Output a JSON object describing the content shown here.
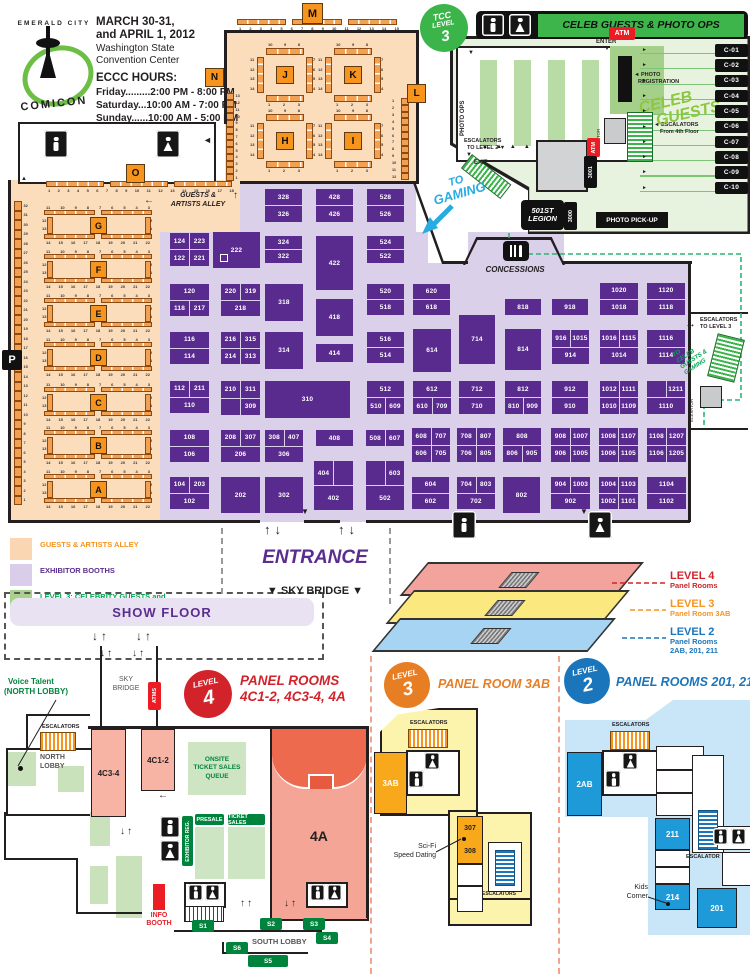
{
  "header": {
    "logo_top": "EMERALD CITY",
    "logo_bottom": "COMICON",
    "dates_l1": "MARCH 30-31,",
    "dates_l2": "and APRIL 1, 2012",
    "venue_l1": "Washington State",
    "venue_l2": "Convention Center",
    "hours_title": "ECCC HOURS:",
    "hours": [
      "Friday.........2:00 PM - 8:00 PM",
      "Saturday...10:00 AM - 7:00 PM",
      "Sunday......10:00 AM - 5:00 PM"
    ]
  },
  "markers": {
    "m": "M",
    "n": "N",
    "l": "L",
    "o": "O",
    "p": "P"
  },
  "tcc": {
    "badge_l1": "TCC",
    "badge_l2": "LEVEL",
    "badge_l3": "3",
    "banner": "CELEB GUESTS & PHOTO OPS",
    "enter": "ENTER",
    "exit": "EXIT",
    "photo_ops": "PHOTO OPS",
    "photo_reg_l1": "PHOTO",
    "photo_reg_l2": "REGISTRATION",
    "elevator": "ELEVATOR",
    "esc4_l1": "ESCALATORS",
    "esc4_l2": "From 4th Floor",
    "esc2_l1": "ESCALATORS",
    "esc2_l2": "TO LEVEL 2",
    "atm": "ATM",
    "to_gaming_l1": "TO",
    "to_gaming_l2": "GAMING",
    "r3001": "3001",
    "legion_l1": "501ST",
    "legion_l2": "LEGION",
    "r3000": "3000",
    "photo_pickup": "PHOTO PICK-UP",
    "celeb_l1": "CELEB",
    "celeb_l2": "GUESTS",
    "booths": [
      "C-01",
      "C-02",
      "C-03",
      "C-04",
      "C-05",
      "C-06",
      "C-07",
      "C-08",
      "C-09",
      "C-10"
    ]
  },
  "alley": {
    "title_l1": "GUESTS &",
    "title_l2": "ARTISTS ALLEY",
    "rows": [
      "G",
      "F",
      "E",
      "D",
      "C",
      "B",
      "A"
    ],
    "top_left": [
      "11",
      "10",
      "9",
      "8"
    ],
    "top_right": [
      "7",
      "6",
      "5",
      "4",
      "3"
    ],
    "bottom_left": [
      "14",
      "15",
      "16",
      "17"
    ],
    "bottom_right": [
      "18",
      "19",
      "20",
      "21",
      "22"
    ],
    "side_left": [
      "12",
      "13"
    ],
    "side_right": [
      "2",
      "1"
    ],
    "west_wall": [
      "32",
      "31",
      "30",
      "29",
      "28",
      "27",
      "26",
      "25",
      "24",
      "23",
      "22",
      "21",
      "20",
      "19",
      "18",
      "17",
      "16",
      "15",
      "14",
      "13",
      "12",
      "11",
      "10",
      "9",
      "8",
      "7",
      "6",
      "5",
      "4",
      "3",
      "2",
      "1"
    ],
    "o_wall": [
      "1",
      "2",
      "3",
      "4",
      "5",
      "6",
      "7",
      "8",
      "9",
      "10",
      "11",
      "12",
      "13",
      "14",
      "15",
      "16",
      "17",
      "18"
    ],
    "m_wall": [
      "1",
      "2",
      "3",
      "4",
      "5",
      "6",
      "7",
      "8",
      "9",
      "10",
      "11",
      "12",
      "13",
      "14",
      "15"
    ],
    "n_wall": [
      "13",
      "12",
      "11",
      "10",
      "9",
      "8",
      "7",
      "6",
      "5",
      "4",
      "3",
      "2",
      "1"
    ],
    "l_wall": [
      "1",
      "2",
      "3",
      "4",
      "5",
      "6",
      "7",
      "8",
      "9",
      "10",
      "11",
      "12"
    ]
  },
  "islands": {
    "letters": [
      "J",
      "K",
      "H",
      "I"
    ],
    "top": [
      "10",
      "9",
      "8"
    ],
    "bottom": [
      "1",
      "2",
      "3"
    ],
    "left": [
      "11",
      "12",
      "13",
      "14"
    ],
    "right": [
      "7",
      "6",
      "5",
      "4"
    ]
  },
  "hall": {
    "concessions": "CONCESSIONS",
    "esc3_l1": "ESCALATORS",
    "esc3_l2": "TO LEVEL 3",
    "to_celeb_l1": "TO",
    "to_celeb_l2": "CELEB",
    "to_celeb_l3": "GUESTS &",
    "to_celeb_l4": "GAMING",
    "elevator": "ELEVATOR",
    "entrance": "ENTRANCE",
    "sky_bridge": "▼ SKY BRIDGE ▼"
  },
  "booths": [
    [
      265,
      189,
      37,
      33,
      [
        [
          "328"
        ],
        [
          "326"
        ]
      ]
    ],
    [
      316,
      189,
      37,
      33,
      [
        [
          "428"
        ],
        [
          "426"
        ]
      ]
    ],
    [
      367,
      189,
      37,
      33,
      [
        [
          "528"
        ],
        [
          "526"
        ]
      ]
    ],
    [
      170,
      233,
      39,
      33,
      [
        [
          "124",
          "223"
        ],
        [
          "122",
          "221"
        ]
      ]
    ],
    [
      213,
      232,
      47,
      36,
      [
        [
          "222"
        ]
      ],
      1
    ],
    [
      265,
      236,
      37,
      27,
      [
        [
          "324"
        ],
        [
          "322"
        ]
      ]
    ],
    [
      316,
      236,
      37,
      54,
      [
        [
          "422"
        ]
      ]
    ],
    [
      367,
      236,
      37,
      27,
      [
        [
          "524"
        ],
        [
          "522"
        ]
      ]
    ],
    [
      170,
      284,
      39,
      32,
      [
        [
          "120"
        ],
        [
          "118",
          "217"
        ]
      ]
    ],
    [
      221,
      284,
      39,
      32,
      [
        [
          "220",
          "319"
        ],
        [
          "218"
        ]
      ]
    ],
    [
      265,
      284,
      38,
      37,
      [
        [
          "318"
        ]
      ]
    ],
    [
      316,
      299,
      37,
      37,
      [
        [
          "418"
        ]
      ]
    ],
    [
      367,
      284,
      37,
      31,
      [
        [
          "520"
        ],
        [
          "518"
        ]
      ]
    ],
    [
      413,
      284,
      37,
      31,
      [
        [
          "620"
        ],
        [
          "618"
        ]
      ]
    ],
    [
      505,
      299,
      36,
      16,
      [
        [
          "818"
        ]
      ]
    ],
    [
      552,
      299,
      36,
      16,
      [
        [
          "918"
        ]
      ]
    ],
    [
      600,
      283,
      38,
      32,
      [
        [
          "1020"
        ],
        [
          "1018"
        ]
      ]
    ],
    [
      647,
      283,
      38,
      32,
      [
        [
          "1120"
        ],
        [
          "1118"
        ]
      ]
    ],
    [
      170,
      332,
      39,
      32,
      [
        [
          "116"
        ],
        [
          "114"
        ]
      ]
    ],
    [
      221,
      332,
      39,
      32,
      [
        [
          "216",
          "315"
        ],
        [
          "214",
          "313"
        ]
      ]
    ],
    [
      265,
      332,
      38,
      37,
      [
        [
          "314"
        ]
      ]
    ],
    [
      316,
      344,
      37,
      18,
      [
        [
          "414"
        ]
      ]
    ],
    [
      367,
      332,
      37,
      31,
      [
        [
          "516"
        ],
        [
          "514"
        ]
      ]
    ],
    [
      413,
      329,
      38,
      43,
      [
        [
          "614"
        ]
      ]
    ],
    [
      459,
      315,
      36,
      49,
      [
        [
          "714"
        ]
      ]
    ],
    [
      505,
      329,
      36,
      41,
      [
        [
          "814"
        ]
      ]
    ],
    [
      552,
      330,
      37,
      34,
      [
        [
          "916",
          "1015"
        ],
        [
          "914"
        ]
      ]
    ],
    [
      600,
      330,
      38,
      34,
      [
        [
          "1016",
          "1115"
        ],
        [
          "1014"
        ]
      ]
    ],
    [
      647,
      330,
      38,
      34,
      [
        [
          "1116"
        ],
        [
          "1114"
        ]
      ]
    ],
    [
      170,
      381,
      39,
      32,
      [
        [
          "112",
          "211"
        ],
        [
          "110"
        ]
      ]
    ],
    [
      221,
      381,
      39,
      34,
      [
        [
          "210",
          "311"
        ],
        [
          "",
          "309"
        ]
      ]
    ],
    [
      265,
      381,
      85,
      37,
      [
        [
          "310"
        ]
      ]
    ],
    [
      367,
      381,
      37,
      33,
      [
        [
          "512"
        ],
        [
          "510",
          "609"
        ]
      ]
    ],
    [
      413,
      381,
      38,
      33,
      [
        [
          "612"
        ],
        [
          "610",
          "709"
        ]
      ]
    ],
    [
      459,
      381,
      36,
      33,
      [
        [
          "712"
        ],
        [
          "710"
        ]
      ]
    ],
    [
      505,
      381,
      36,
      33,
      [
        [
          "812"
        ],
        [
          "810",
          "909"
        ]
      ]
    ],
    [
      552,
      381,
      36,
      33,
      [
        [
          "912"
        ],
        [
          "910"
        ]
      ]
    ],
    [
      600,
      381,
      38,
      33,
      [
        [
          "1012",
          "1111"
        ],
        [
          "1010",
          "1109"
        ]
      ]
    ],
    [
      647,
      381,
      38,
      33,
      [
        [
          "",
          "1211"
        ],
        [
          "1110"
        ]
      ]
    ],
    [
      170,
      430,
      39,
      32,
      [
        [
          "108"
        ],
        [
          "106"
        ]
      ]
    ],
    [
      221,
      430,
      39,
      32,
      [
        [
          "208",
          "307"
        ],
        [
          "206"
        ]
      ]
    ],
    [
      265,
      430,
      38,
      32,
      [
        [
          "308",
          "407"
        ],
        [
          "306"
        ]
      ]
    ],
    [
      316,
      430,
      37,
      16,
      [
        [
          "408"
        ]
      ]
    ],
    [
      366,
      430,
      38,
      16,
      [
        [
          "508",
          "607"
        ]
      ]
    ],
    [
      412,
      428,
      38,
      34,
      [
        [
          "608",
          "707"
        ],
        [
          "606",
          "705"
        ]
      ]
    ],
    [
      457,
      428,
      38,
      34,
      [
        [
          "708",
          "807"
        ],
        [
          "706",
          "805"
        ]
      ]
    ],
    [
      503,
      428,
      38,
      34,
      [
        [
          "808"
        ],
        [
          "806",
          "905"
        ]
      ]
    ],
    [
      551,
      428,
      39,
      34,
      [
        [
          "908",
          "1007"
        ],
        [
          "906",
          "1005"
        ]
      ]
    ],
    [
      599,
      428,
      39,
      34,
      [
        [
          "1008",
          "1107"
        ],
        [
          "1006",
          "1105"
        ]
      ]
    ],
    [
      647,
      428,
      39,
      34,
      [
        [
          "1108",
          "1207"
        ],
        [
          "1106",
          "1205"
        ]
      ]
    ],
    [
      170,
      477,
      39,
      32,
      [
        [
          "104",
          "203"
        ],
        [
          "102"
        ]
      ]
    ],
    [
      221,
      477,
      39,
      36,
      [
        [
          "202"
        ]
      ]
    ],
    [
      265,
      477,
      38,
      36,
      [
        [
          "302"
        ]
      ]
    ],
    [
      314,
      461,
      39,
      49,
      [
        [
          "404",
          ""
        ],
        [
          "402"
        ]
      ]
    ],
    [
      366,
      461,
      38,
      49,
      [
        [
          "",
          "603"
        ],
        [
          "502"
        ]
      ]
    ],
    [
      412,
      477,
      37,
      32,
      [
        [
          "604"
        ],
        [
          "602"
        ]
      ]
    ],
    [
      457,
      477,
      38,
      32,
      [
        [
          "704",
          "803"
        ],
        [
          "702"
        ]
      ]
    ],
    [
      503,
      477,
      37,
      36,
      [
        [
          "802"
        ]
      ]
    ],
    [
      551,
      477,
      39,
      32,
      [
        [
          "904",
          "1003"
        ],
        [
          "902"
        ]
      ]
    ],
    [
      599,
      477,
      39,
      32,
      [
        [
          "1004",
          "1103"
        ],
        [
          "1002",
          "1101"
        ]
      ]
    ],
    [
      647,
      477,
      39,
      32,
      [
        [
          "1104"
        ],
        [
          "1102"
        ]
      ]
    ]
  ],
  "legend": {
    "items": [
      {
        "l1": "GUESTS & ARTISTS ALLEY",
        "l2": "",
        "fill": "#FAD7B2",
        "color": "#F7941D"
      },
      {
        "l1": "EXHIBITOR BOOTHS",
        "l2": "",
        "fill": "#D9CDE9",
        "color": "#5B2D8E"
      },
      {
        "l1": "LEVEL 3: CELEBRITY GUESTS and",
        "l2": "ESCALATORS TO GAMING",
        "fill": "#A9D18E",
        "color": "#00A651"
      }
    ]
  },
  "show_floor": "SHOW FLOOR",
  "levels_diagram": {
    "items": [
      {
        "label": "LEVEL 4",
        "sub1": "Panel Rooms",
        "sub2": "",
        "color": "#D2232A",
        "fill": "#F2A39B"
      },
      {
        "label": "LEVEL 3",
        "sub1": "Panel Room 3AB",
        "sub2": "",
        "color": "#F7941D",
        "fill": "#FBE87F"
      },
      {
        "label": "LEVEL 2",
        "sub1": "Panel Rooms",
        "sub2": "2AB, 201, 211",
        "color": "#1B75BB",
        "fill": "#A6D4F2"
      }
    ]
  },
  "level4": {
    "badge_l1": "LEVEL",
    "badge_l2": "4",
    "title_l1": "PANEL ROOMS",
    "title_l2": "4C1-2, 4C3-4, 4A",
    "voice_l1": "Voice Talent",
    "voice_l2": "(NORTH LOBBY)",
    "sky_l1": "SKY",
    "sky_l2": "BRIDGE",
    "atms": "ATMS",
    "escalators": "ESCALATORS",
    "lobby_l1": "NORTH",
    "lobby_l2": "LOBBY",
    "r4c34": "4C3-4",
    "r4c12": "4C1-2",
    "r4a": "4A",
    "queue_l1": "ONSITE",
    "queue_l2": "TICKET SALES",
    "queue_l3": "QUEUE",
    "presale": "PRESALE",
    "tickets": "TICKET SALES",
    "exreg": "EXHIBITOR REG.",
    "info_l1": "INFO",
    "info_l2": "BOOTH",
    "south": "SOUTH LOBBY",
    "stairs": [
      "S1",
      "S2",
      "S3",
      "S4",
      "S5",
      "S6"
    ]
  },
  "level3": {
    "badge_l1": "LEVEL",
    "badge_l2": "3",
    "title": "PANEL ROOM 3AB",
    "escalators": "ESCALATORS",
    "r3ab": "3AB",
    "r307": "307",
    "r308": "308",
    "scifi_l1": "Sci-Fi",
    "scifi_l2": "Speed Dating",
    "escalators2": "ESCALATORS"
  },
  "level2": {
    "badge_l1": "LEVEL",
    "badge_l2": "2",
    "title": "PANEL ROOMS 201, 211",
    "escalators": "ESCALATORS",
    "r2ab": "2AB",
    "r211": "211",
    "r214": "214",
    "r201": "201",
    "escalator": "ESCALATOR",
    "kids_l1": "Kids",
    "kids_l2": "Corner"
  }
}
